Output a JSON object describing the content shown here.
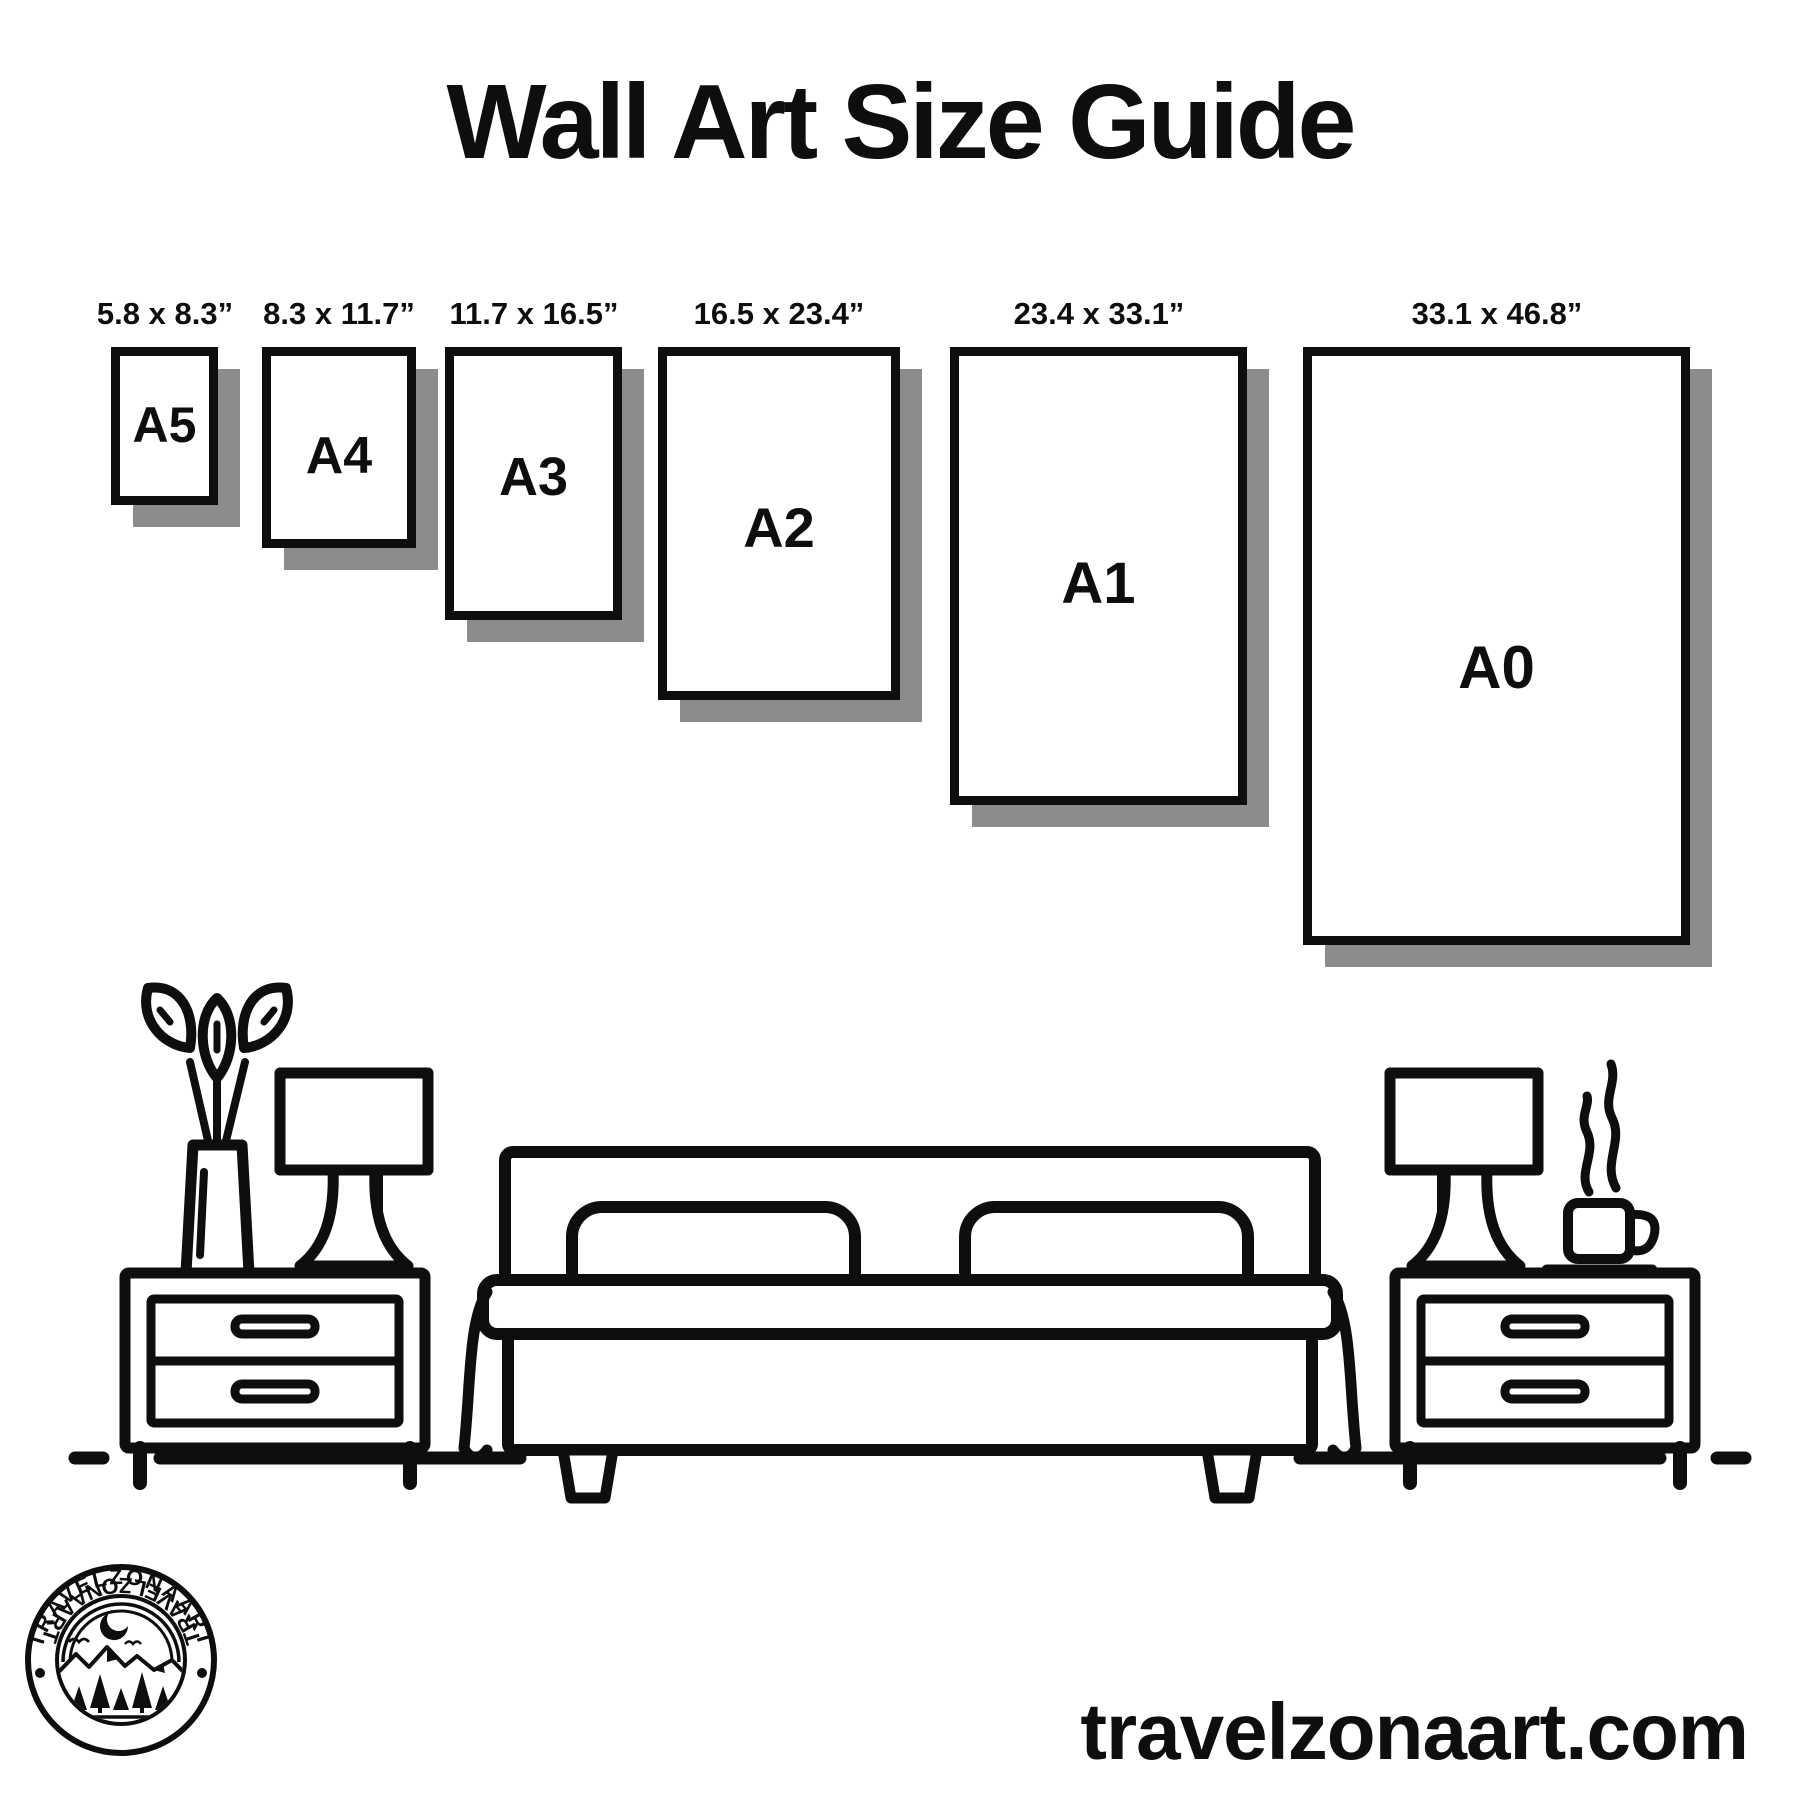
{
  "title": "Wall Art Size Guide",
  "sizes": [
    {
      "label": "A5",
      "dimensions": "5.8 x 8.3”"
    },
    {
      "label": "A4",
      "dimensions": "8.3 x 11.7”"
    },
    {
      "label": "A3",
      "dimensions": "11.7 x 16.5”"
    },
    {
      "label": "A2",
      "dimensions": "16.5 x 23.4”"
    },
    {
      "label": "A1",
      "dimensions": "23.4 x 33.1”"
    },
    {
      "label": "A0",
      "dimensions": "33.1 x 46.8”"
    }
  ],
  "logo": {
    "brand_top": "TRAVELZONAART",
    "brand_bottom": "TRAVELZONAART"
  },
  "footer": {
    "website": "travelzonaart.com"
  },
  "colors": {
    "ink": "#0e0e0e",
    "frame_shadow": "#8c8c8c",
    "background": "#ffffff"
  }
}
